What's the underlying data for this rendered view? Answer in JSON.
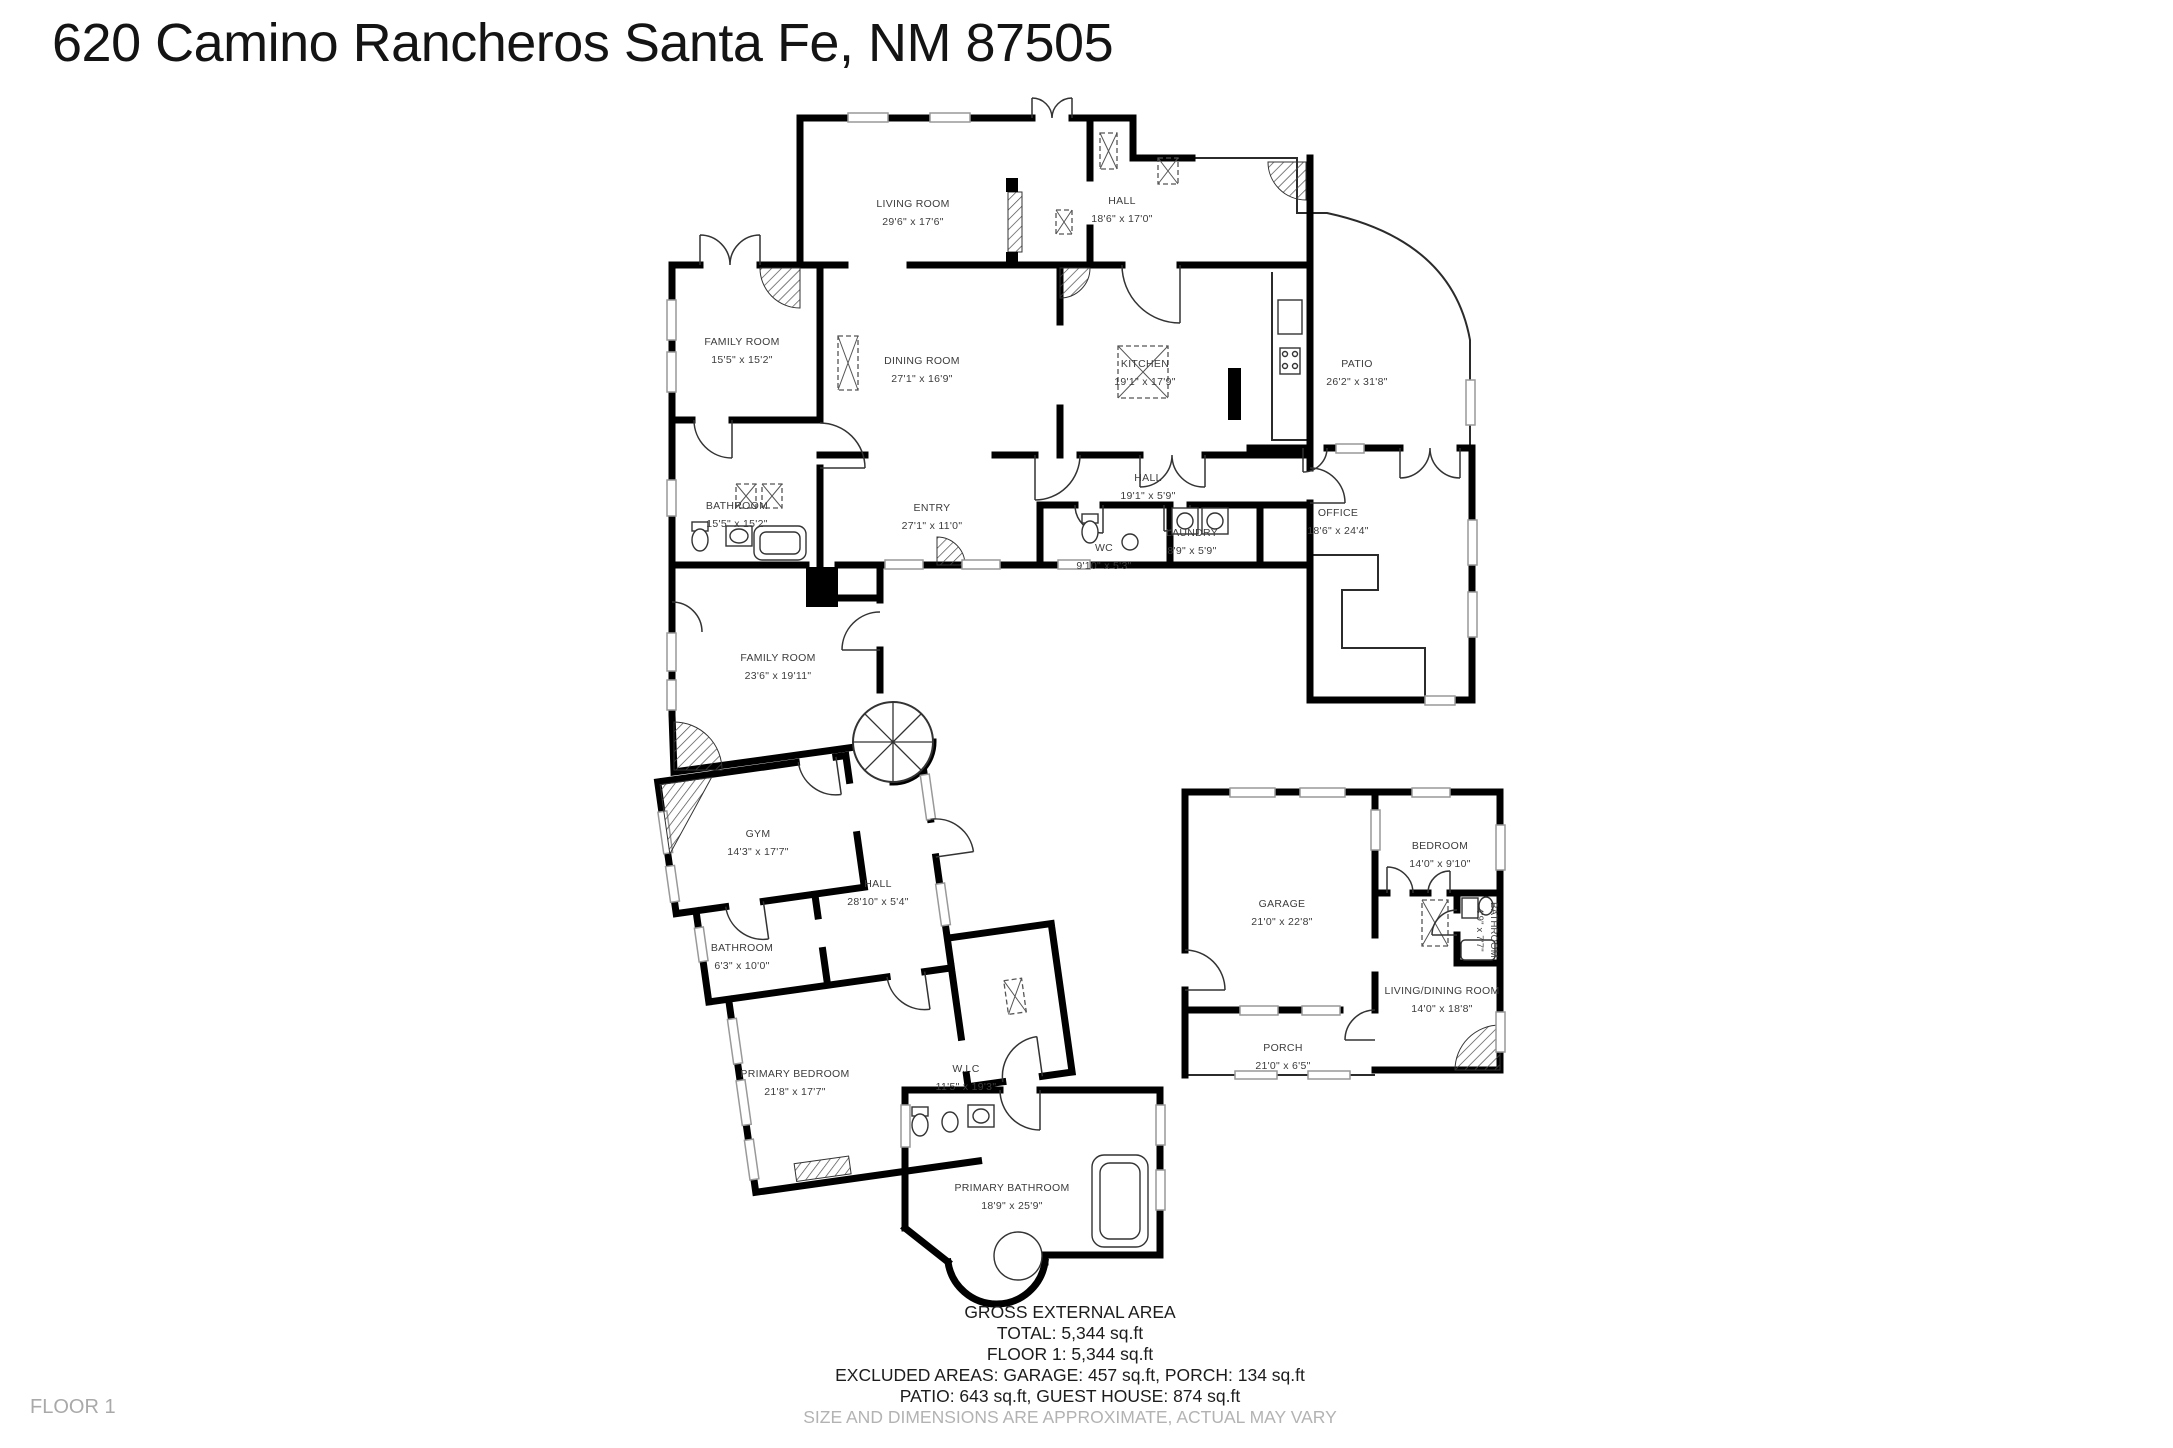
{
  "title": "620 Camino Rancheros Santa Fe, NM 87505",
  "floor_label": "FLOOR 1",
  "colors": {
    "wall": "#000000",
    "label": "#3c3c3c",
    "muted": "#b3b3b3"
  },
  "rooms": {
    "living_room": {
      "name": "LIVING ROOM",
      "dims": "29'6\" x 17'6\""
    },
    "hall_top": {
      "name": "HALL",
      "dims": "18'6\" x 17'0\""
    },
    "family_room_1": {
      "name": "FAMILY ROOM",
      "dims": "15'5\" x 15'2\""
    },
    "dining_room": {
      "name": "DINING ROOM",
      "dims": "27'1\" x 16'9\""
    },
    "kitchen": {
      "name": "KITCHEN",
      "dims": "19'1\" x 17'9\""
    },
    "patio": {
      "name": "PATIO",
      "dims": "26'2\" x 31'8\""
    },
    "bathroom_1": {
      "name": "BATHROOM",
      "dims": "15'5\" x 15'2\""
    },
    "entry": {
      "name": "ENTRY",
      "dims": "27'1\" x 11'0\""
    },
    "hall_mid": {
      "name": "HALL",
      "dims": "19'1\" x 5'9\""
    },
    "wc": {
      "name": "WC",
      "dims": "9'10\" x 5'3\""
    },
    "laundry": {
      "name": "LAUNDRY",
      "dims": "8'9\" x 5'9\""
    },
    "office": {
      "name": "OFFICE",
      "dims": "18'6\" x 24'4\""
    },
    "family_room_2": {
      "name": "FAMILY ROOM",
      "dims": "23'6\" x 19'11\""
    },
    "gym": {
      "name": "GYM",
      "dims": "14'3\" x 17'7\""
    },
    "hall_wing": {
      "name": "HALL",
      "dims": "28'10\" x 5'4\""
    },
    "bathroom_2": {
      "name": "BATHROOM",
      "dims": "6'3\" x 10'0\""
    },
    "primary_bedroom": {
      "name": "PRIMARY BEDROOM",
      "dims": "21'8\" x 17'7\""
    },
    "wic": {
      "name": "W.I.C",
      "dims": "11'5\" x 19'3\""
    },
    "primary_bathroom": {
      "name": "PRIMARY BATHROOM",
      "dims": "18'9\" x 25'9\""
    },
    "garage": {
      "name": "GARAGE",
      "dims": "21'0\" x 22'8\""
    },
    "bedroom_guest": {
      "name": "BEDROOM",
      "dims": "14'0\" x 9'10\""
    },
    "bathroom_guest": {
      "name": "BATHROOM",
      "dims": "4'9\" x 7'7\""
    },
    "living_dining": {
      "name": "LIVING/DINING ROOM",
      "dims": "14'0\" x 18'8\""
    },
    "porch": {
      "name": "PORCH",
      "dims": "21'0\" x 6'5\""
    }
  },
  "summary": {
    "heading": "GROSS EXTERNAL AREA",
    "total": "TOTAL: 5,344 sq.ft",
    "floor1": "FLOOR 1: 5,344 sq.ft",
    "excluded1": "EXCLUDED AREAS: GARAGE: 457 sq.ft, PORCH: 134 sq.ft",
    "excluded2": "PATIO: 643 sq.ft, GUEST HOUSE: 874 sq.ft",
    "disclaimer": "SIZE AND DIMENSIONS ARE APPROXIMATE, ACTUAL MAY VARY"
  }
}
